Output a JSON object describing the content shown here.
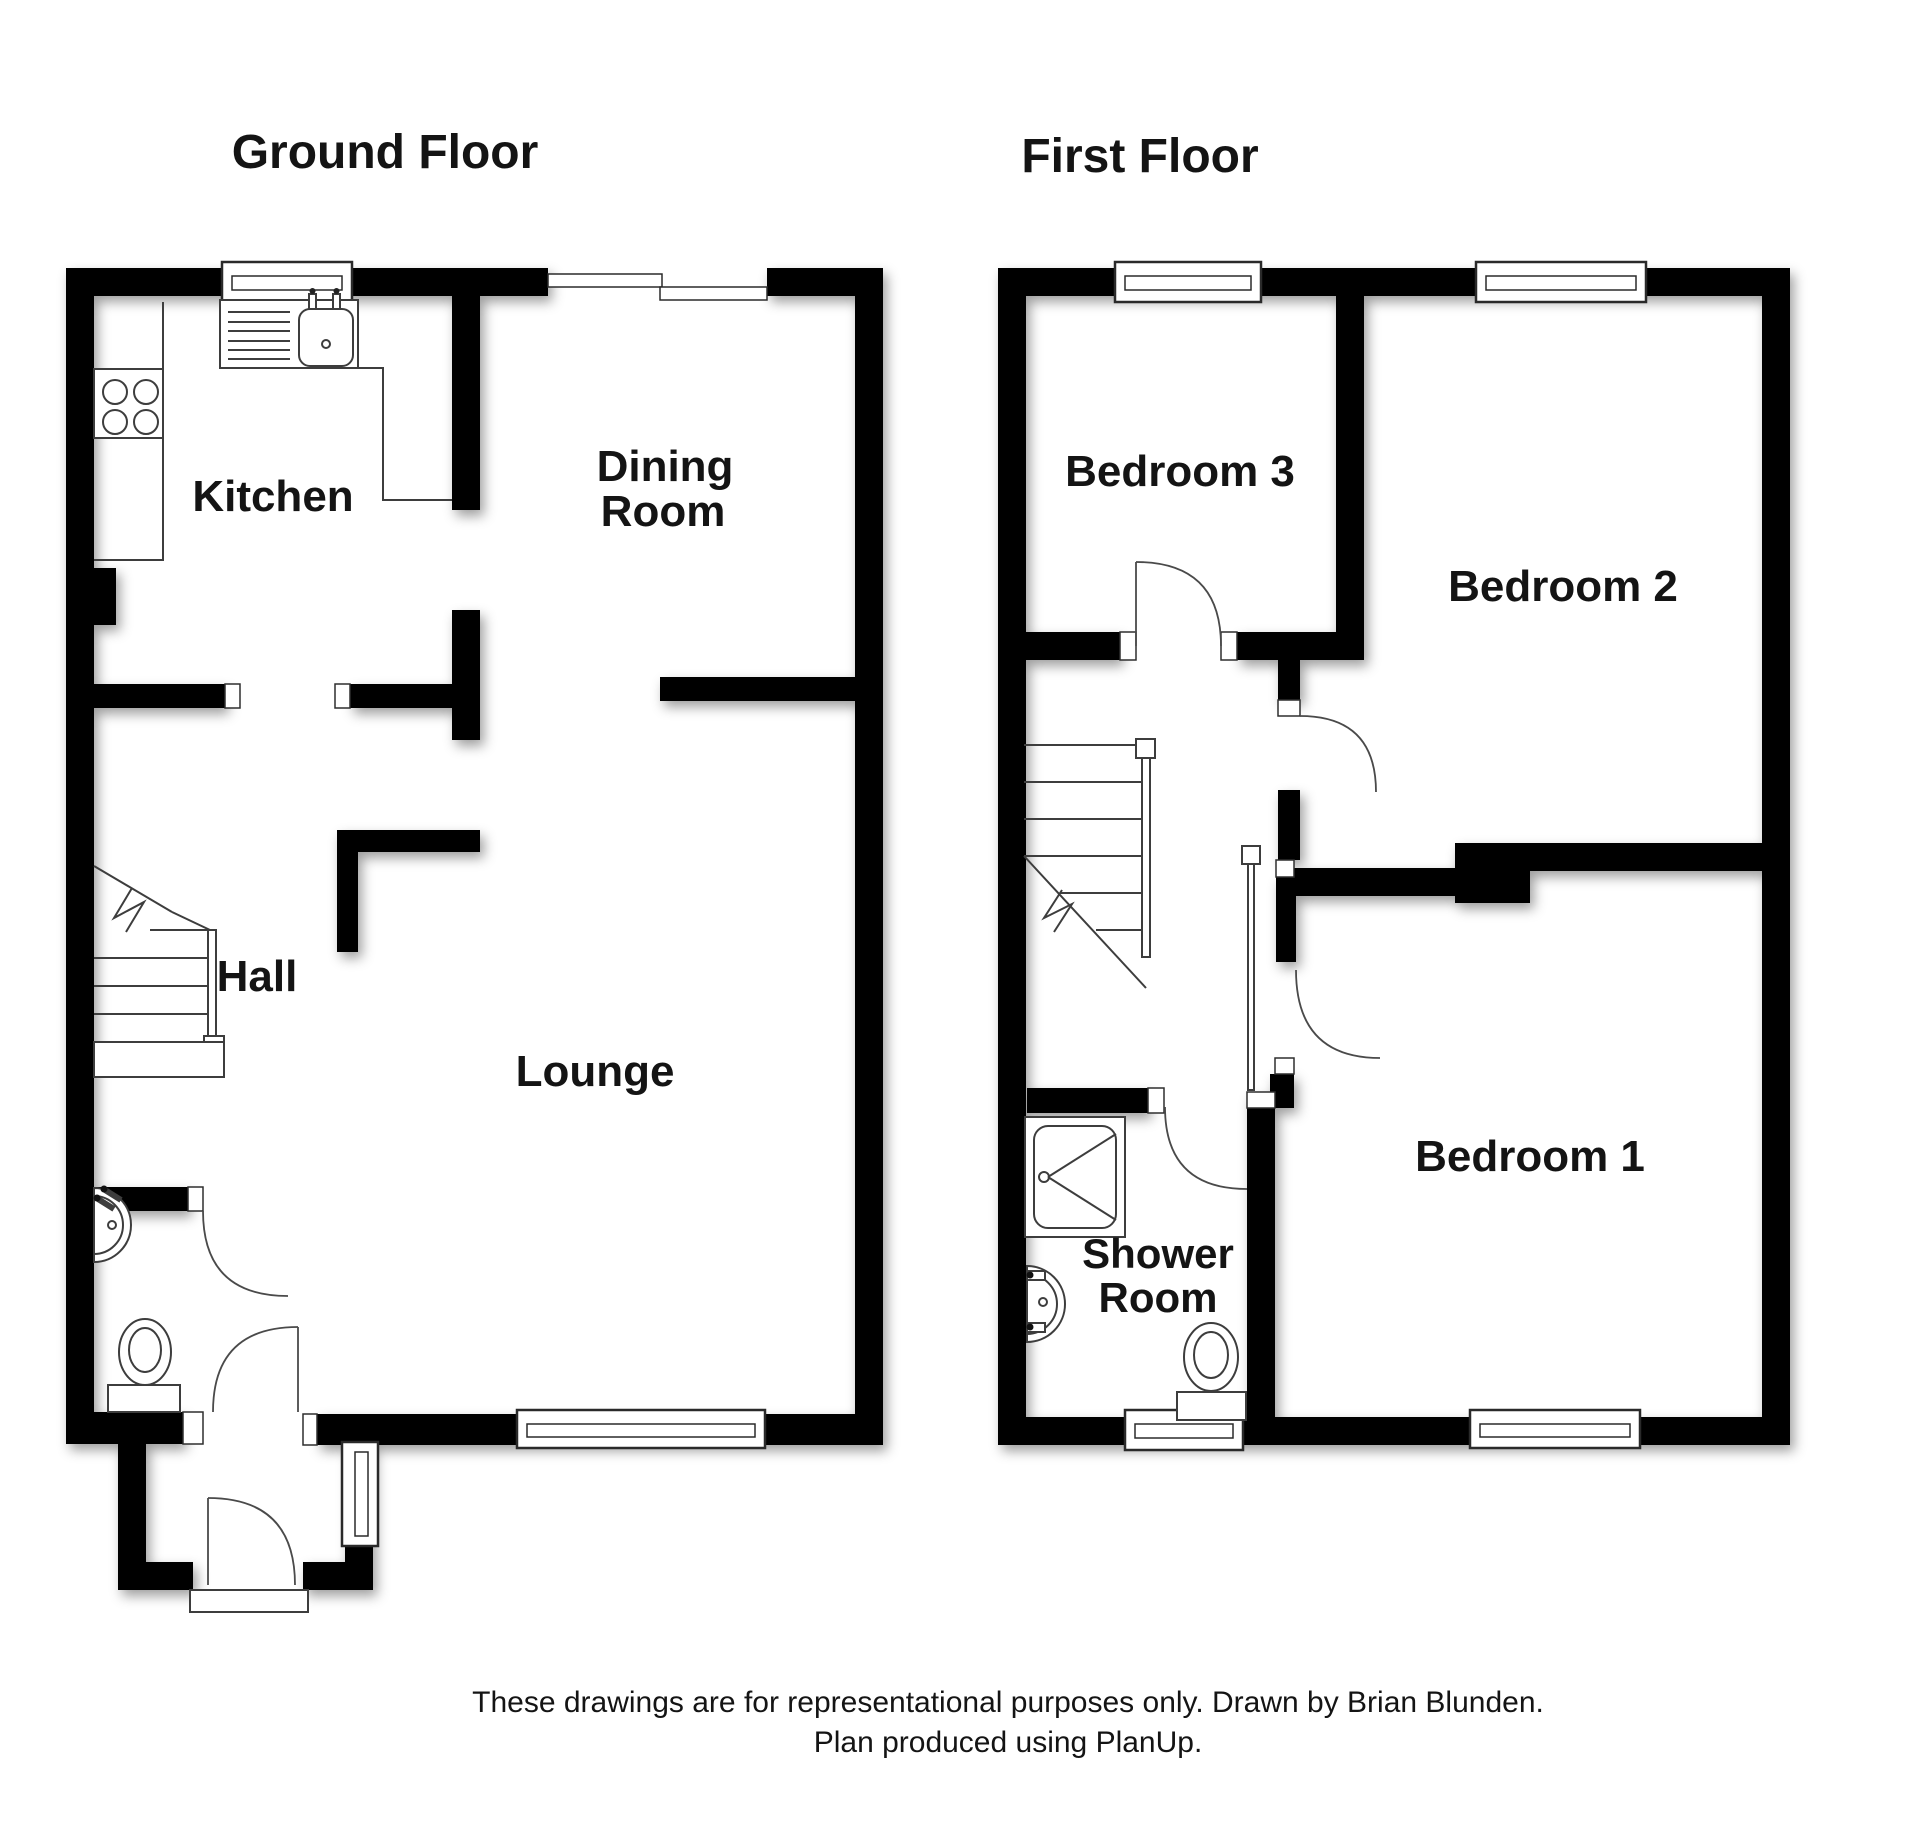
{
  "ground_floor": {
    "title": "Ground Floor",
    "rooms": {
      "kitchen": {
        "label": "Kitchen"
      },
      "dining_room": {
        "label_line1": "Dining",
        "label_line2": "Room"
      },
      "hall": {
        "label": "Hall"
      },
      "lounge": {
        "label": "Lounge"
      }
    }
  },
  "first_floor": {
    "title": "First Floor",
    "rooms": {
      "bedroom3": {
        "label": "Bedroom 3"
      },
      "bedroom2": {
        "label": "Bedroom 2"
      },
      "bedroom1": {
        "label": "Bedroom 1"
      },
      "shower_room": {
        "label_line1": "Shower",
        "label_line2": "Room"
      }
    }
  },
  "footer": {
    "line1": "These drawings are for representational purposes only. Drawn by Brian Blunden.",
    "line2": "Plan produced using PlanUp."
  },
  "colors": {
    "wall": "#050505",
    "background": "#ffffff",
    "fixture_line": "#3d3d3d",
    "text": "#141414"
  }
}
